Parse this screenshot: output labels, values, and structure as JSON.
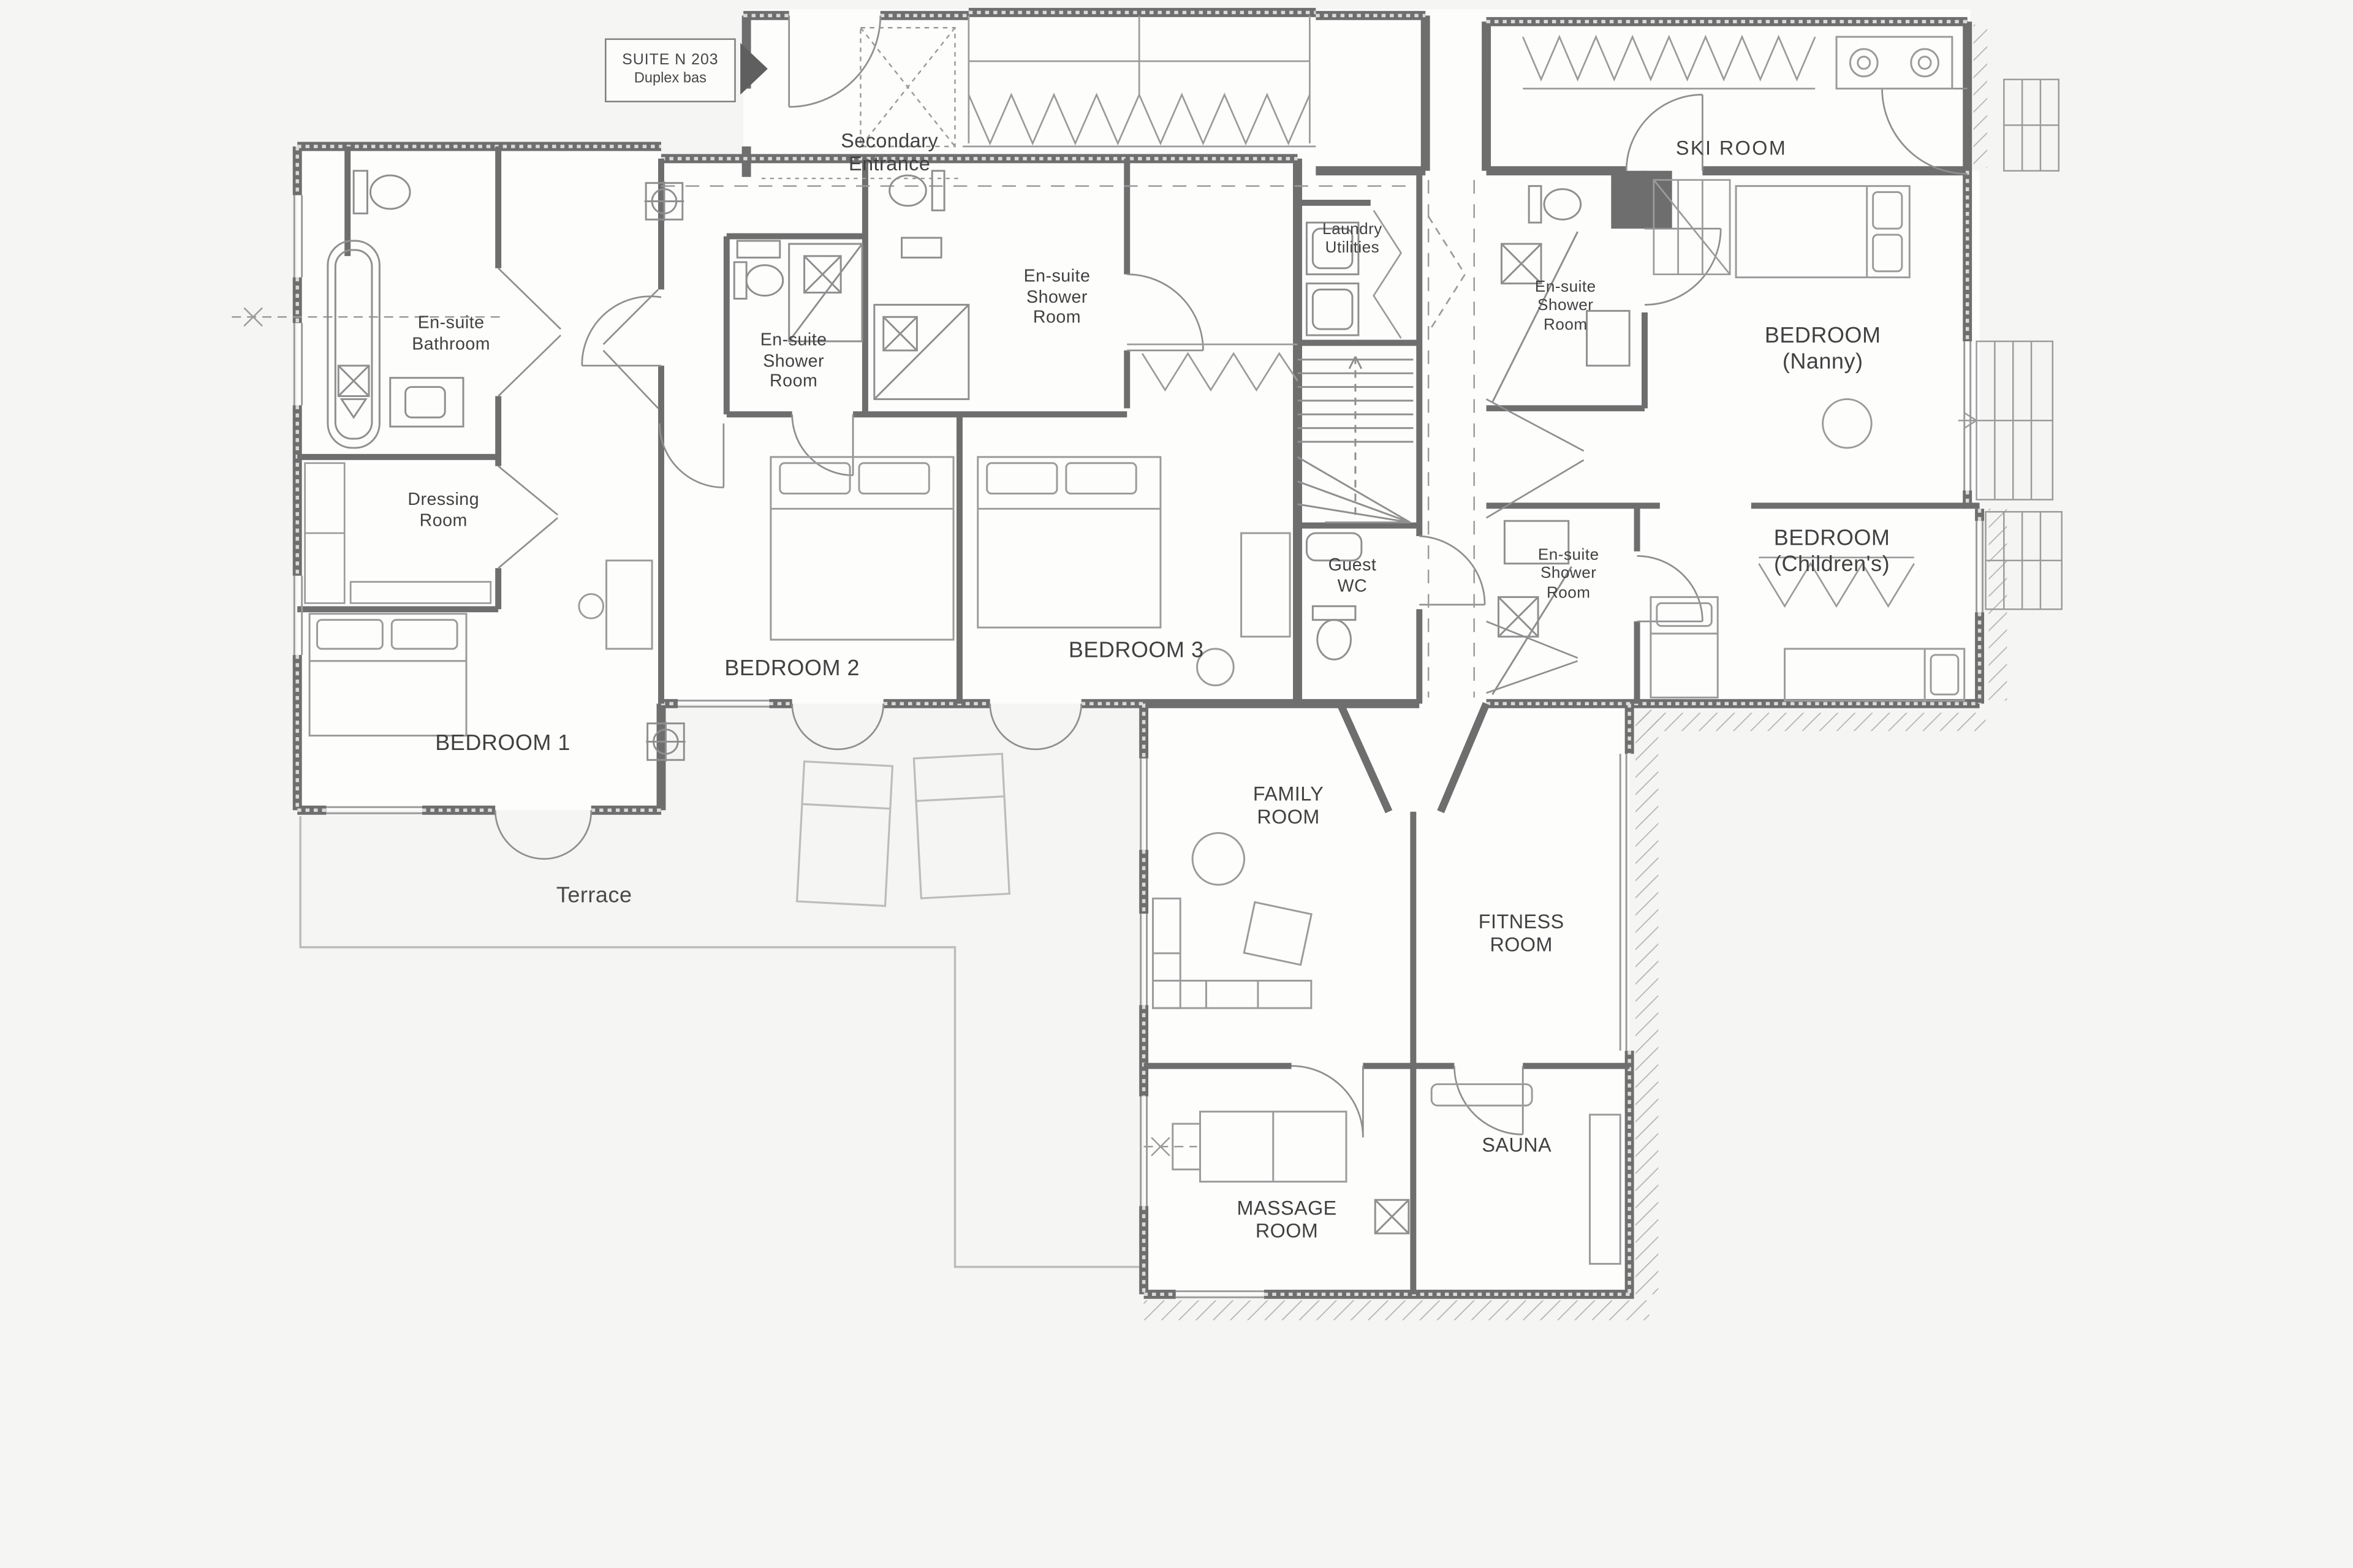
{
  "plan": {
    "suite_tag": {
      "line1": "SUITE  N 203",
      "line2": "Duplex bas"
    },
    "rooms": {
      "secondary_entrance": "Secondary\nEntrance",
      "ski_room": "SKI ROOM",
      "ensuite_bathroom": "En-suite\nBathroom",
      "dressing_room": "Dressing\nRoom",
      "bedroom_1": "BEDROOM 1",
      "ensuite_shower_bedroom2": "En-suite\nShower\nRoom",
      "bedroom_2": "BEDROOM 2",
      "ensuite_shower_bedroom3": "En-suite\nShower\nRoom",
      "bedroom_3": "BEDROOM 3",
      "laundry_utilities": "Laundry\nUtilities",
      "guest_wc": "Guest\nWC",
      "ensuite_shower_nanny": "En-suite\nShower\nRoom",
      "bedroom_nanny": "BEDROOM\n(Nanny)",
      "ensuite_shower_children": "En-suite\nShower\nRoom",
      "bedroom_children": "BEDROOM\n(Children's)",
      "family_room": "FAMILY\nROOM",
      "fitness_room": "FITNESS\nROOM",
      "sauna": "SAUNA",
      "massage_room": "MASSAGE\nROOM",
      "terrace": "Terrace"
    },
    "icons": {
      "suite_pointer": "right-triangle",
      "level_marker": "crosshair-circle"
    },
    "colors": {
      "wall": "#6e6e6e",
      "line": "#9b9b9b",
      "line_light": "#bcbcbc",
      "text": "#414141",
      "background": "#f5f5f4",
      "paper": "#fdfdfc"
    }
  }
}
